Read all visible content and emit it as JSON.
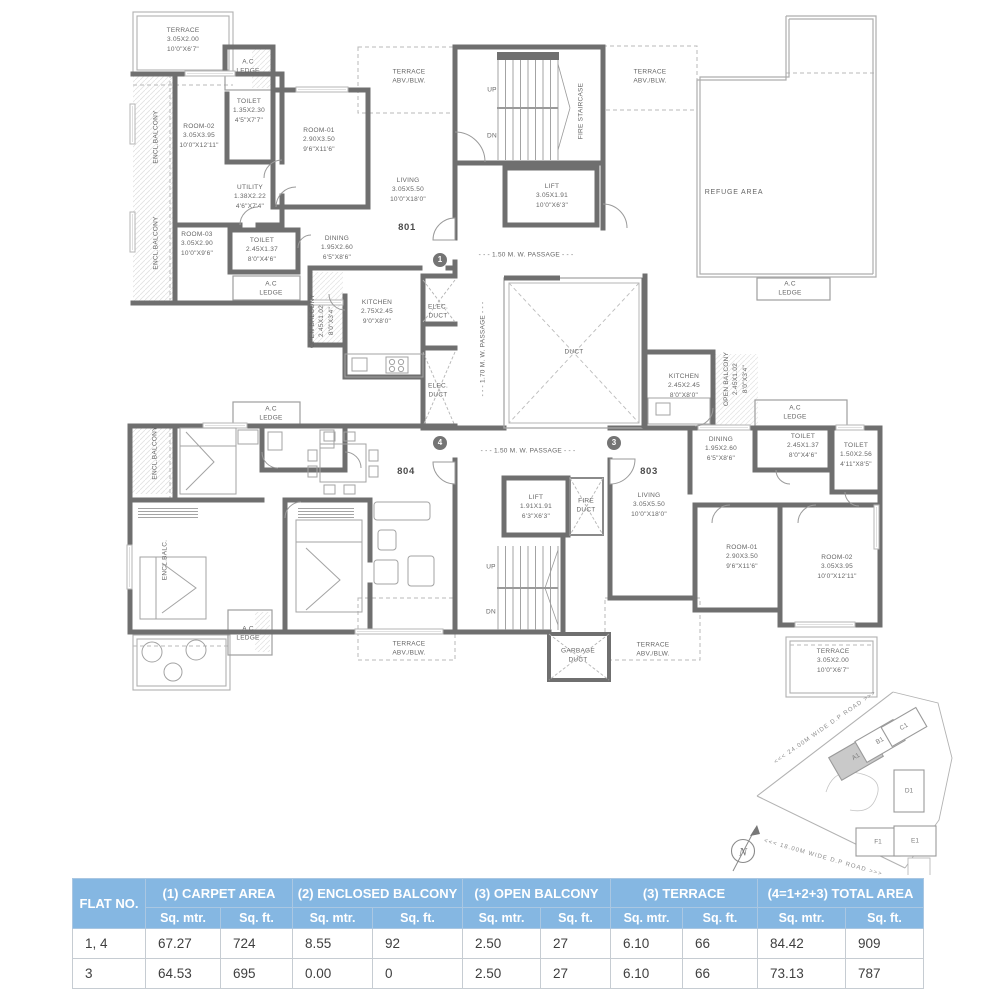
{
  "plan": {
    "flats": {
      "f801": "801",
      "f804": "804",
      "f803": "803"
    },
    "circles": {
      "one": "1",
      "four": "4",
      "three": "3"
    },
    "r801": {
      "terrace": {
        "n": "TERRACE",
        "m": "3.05X2.00",
        "f": "10'0\"X6'7\""
      },
      "toilet_a": {
        "n": "TOILET",
        "m": "1.35X2.30",
        "f": "4'5\"X7'7\""
      },
      "room02": {
        "n": "ROOM-02",
        "m": "3.05X3.95",
        "f": "10'0\"X12'11\""
      },
      "room01": {
        "n": "ROOM-01",
        "m": "2.90X3.50",
        "f": "9'6\"X11'6\""
      },
      "utility": {
        "n": "UTILITY",
        "m": "1.38X2.22",
        "f": "4'6\"X7'4\""
      },
      "room03": {
        "n": "ROOM-03",
        "m": "3.05X2.90",
        "f": "10'0\"X9'6\""
      },
      "toilet_b": {
        "n": "TOILET",
        "m": "2.45X1.37",
        "f": "8'0\"X4'6\""
      },
      "dining": {
        "n": "DINING",
        "m": "1.95X2.60",
        "f": "6'5\"X8'6\""
      },
      "kitchen": {
        "n": "KITCHEN",
        "m": "2.75X2.45",
        "f": "9'0\"X8'0\""
      },
      "living": {
        "n": "LIVING",
        "m": "3.05X5.50",
        "f": "10'0\"X18'0\""
      },
      "open_balcony": {
        "n": "OPEN BALCONY",
        "m": "2.45X1.02",
        "f": "8'0\"X3'4\""
      }
    },
    "r803": {
      "kitchen": {
        "n": "KITCHEN",
        "m": "2.45X2.45",
        "f": "8'0\"X8'0\""
      },
      "dining": {
        "n": "DINING",
        "m": "1.95X2.60",
        "f": "6'5\"X8'6\""
      },
      "toilet_a": {
        "n": "TOILET",
        "m": "2.45X1.37",
        "f": "8'0\"X4'6\""
      },
      "toilet_b": {
        "n": "TOILET",
        "m": "1.50X2.56",
        "f": "4'11\"X8'5\""
      },
      "living": {
        "n": "LIVING",
        "m": "3.05X5.50",
        "f": "10'0\"X18'0\""
      },
      "room01": {
        "n": "ROOM-01",
        "m": "2.90X3.50",
        "f": "9'6\"X11'6\""
      },
      "room02": {
        "n": "ROOM-02",
        "m": "3.05X3.95",
        "f": "10'0\"X12'11\""
      },
      "terrace": {
        "n": "TERRACE",
        "m": "3.05X2.00",
        "f": "10'0\"X6'7\""
      },
      "open_balcony": {
        "n": "OPEN BALCONY",
        "m": "2.45X1.02",
        "f": "8'0\"X3'4\""
      }
    },
    "core": {
      "lift_top": {
        "n": "LIFT",
        "m": "3.05X1.91",
        "f": "10'0\"X6'3\""
      },
      "lift_bottom": {
        "n": "LIFT",
        "m": "1.91X1.91",
        "f": "6'3\"X6'3\""
      },
      "fire_staircase": "FIRE STAIRCASE",
      "duct": "DUCT",
      "up": "UP",
      "dn": "DN",
      "elec_duct": {
        "l1": "ELEC.",
        "l2": "DUCT"
      },
      "fire_duct": {
        "l1": "FIRE",
        "l2": "DUCT"
      },
      "garbage_duct": {
        "l1": "GARBAGE",
        "l2": "DUCT"
      }
    },
    "shared": {
      "ac_ledge": {
        "l1": "A.C",
        "l2": "LEDGE"
      },
      "terrace_abv": {
        "l1": "TERRACE",
        "l2": "ABV./BLW."
      },
      "encl_balcony": "ENCL.BALCONY",
      "encl_balc": "ENCL.BALC.",
      "refuge": "REFUGE AREA"
    },
    "passages": {
      "p150": "- - - 1.50 M. W. PASSAGE - - -",
      "p170": "- - - 1.70 M. W. PASSAGE - - -"
    }
  },
  "site": {
    "road_top": "<<<  24.00M WIDE D.P ROAD  >>>",
    "road_bottom": "<<<  18.00M WIDE D.P ROAD  >>>",
    "north": "N",
    "buildings": {
      "a1": "A1",
      "b1": "B1",
      "c1": "C1",
      "d1": "D1",
      "e1": "E1",
      "f1": "F1"
    }
  },
  "table": {
    "col1": "FLAT NO.",
    "groups": [
      "(1) CARPET AREA",
      "(2) ENCLOSED BALCONY",
      "(3) OPEN BALCONY",
      "(3) TERRACE",
      "(4=1+2+3)  TOTAL AREA"
    ],
    "sub_m": "Sq. mtr.",
    "sub_f": "Sq. ft.",
    "header_bg": "#85b7e2",
    "rows": [
      {
        "flat": "1, 4",
        "values": [
          "67.27",
          "724",
          "8.55",
          "92",
          "2.50",
          "27",
          "6.10",
          "66",
          "84.42",
          "909"
        ]
      },
      {
        "flat": "3",
        "values": [
          "64.53",
          "695",
          "0.00",
          "0",
          "2.50",
          "27",
          "6.10",
          "66",
          "73.13",
          "787"
        ]
      }
    ]
  }
}
